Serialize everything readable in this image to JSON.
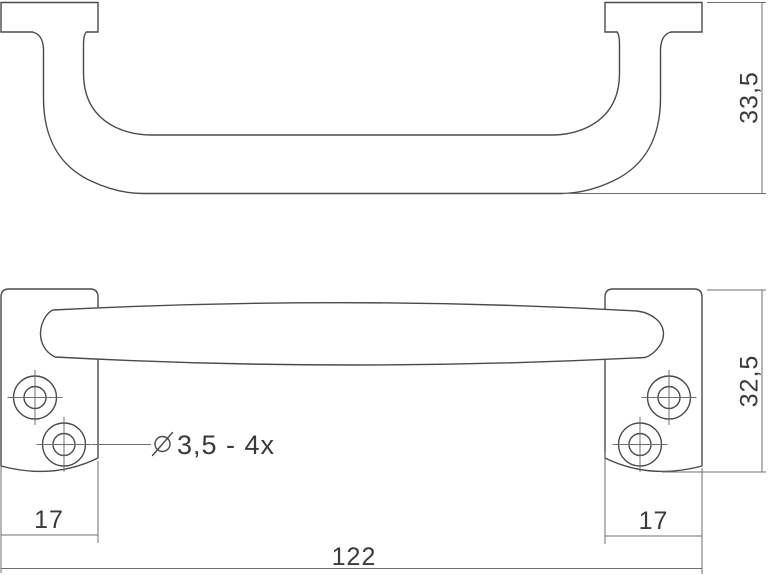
{
  "drawing": {
    "top_view": {
      "height_dim": "33,5"
    },
    "front_view": {
      "height_dim": "32,5",
      "plate_width_left_dim": "17",
      "plate_width_right_dim": "17",
      "overall_length_dim": "122",
      "hole_note": "3,5 - 4x"
    },
    "colors": {
      "background": "#ffffff",
      "object_line": "#4a4a4a",
      "dim_line": "#6f6f6f",
      "text": "#3a3a3a",
      "grip_fill": "#ffffff"
    }
  }
}
